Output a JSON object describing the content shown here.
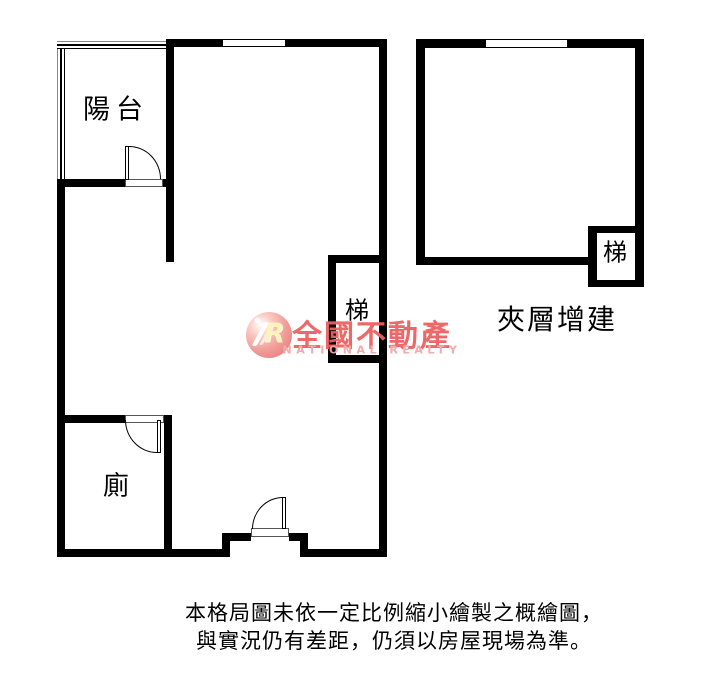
{
  "plan": {
    "labels": {
      "balcony": "陽台",
      "toilet": "廁",
      "stair_left": "梯",
      "stair_right": "梯",
      "mezzanine": "夾層增建"
    }
  },
  "watermark": {
    "brand": "全國不動產",
    "brand_en": "NATIONAL REALTY",
    "monogram": "R"
  },
  "disclaimer": {
    "line1": "本格局圖未依一定比例縮小繪製之概繪圖，",
    "line2": "與實況仍有差距，仍須以房屋現場為準。"
  },
  "colors": {
    "wall": "#000000",
    "background": "#ffffff",
    "brand_red": "#ed6161",
    "brand_pink": "#f2a6a6"
  }
}
